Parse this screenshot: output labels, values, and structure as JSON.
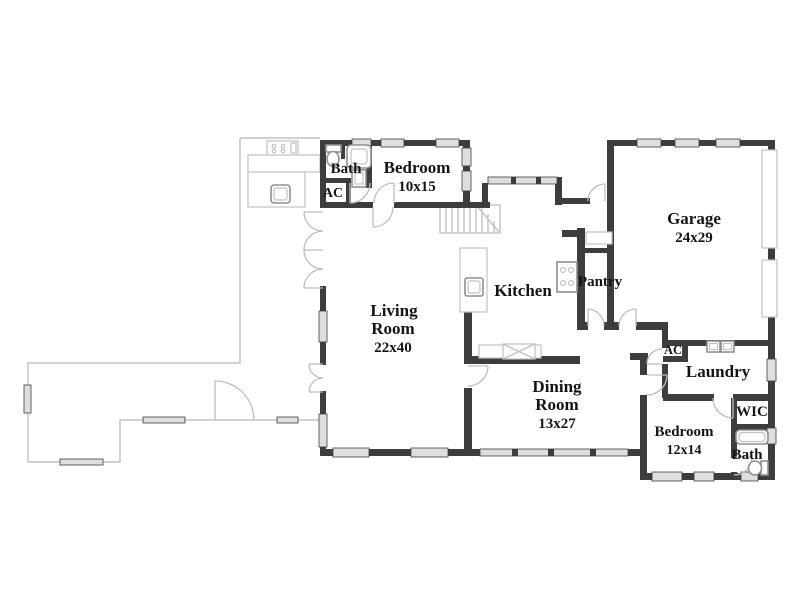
{
  "plan_title": "Single-story floor plan",
  "colors": {
    "wall": "#3d3d3d",
    "light_line": "#c2c2c2",
    "window_fill": "#dedede",
    "label": "#141414",
    "background": "#ffffff"
  },
  "rooms": {
    "bath_upper": {
      "name": "Bath"
    },
    "ac_upper": {
      "name": "AC"
    },
    "bedroom_upper": {
      "name": "Bedroom",
      "dims": "10x15"
    },
    "garage": {
      "name": "Garage",
      "dims": "24x29"
    },
    "kitchen": {
      "name": "Kitchen"
    },
    "pantry": {
      "name": "Pantry"
    },
    "living_room": {
      "name": "Living",
      "name2": "Room",
      "dims": "22x40"
    },
    "dining_room": {
      "name": "Dining",
      "name2": "Room",
      "dims": "13x27"
    },
    "laundry": {
      "name": "Laundry"
    },
    "ac_right": {
      "name": "AC"
    },
    "wic": {
      "name": "WIC"
    },
    "bedroom_lower": {
      "name": "Bedroom",
      "dims": "12x14"
    },
    "bath_lower": {
      "name": "Bath"
    }
  }
}
